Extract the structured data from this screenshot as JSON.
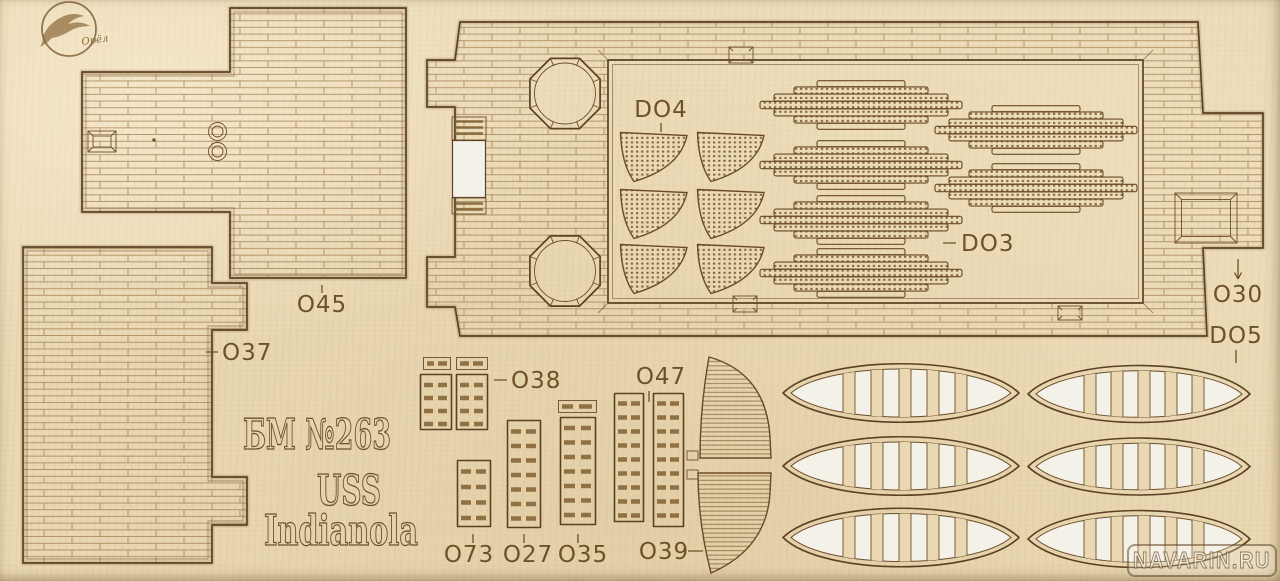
{
  "sheet": {
    "description": "Laser-cut plywood model parts sheet",
    "logo": {
      "brand": "Орёл"
    },
    "watermark": "NAVARIN.RU",
    "titles": {
      "kit": "БМ №263",
      "prefix": "USS",
      "name": "Indianola"
    },
    "labels": {
      "o45": "O45",
      "o37": "O37",
      "do4": "DO4",
      "do3": "DO3",
      "o30": "O30",
      "do5": "DO5",
      "o38": "O38",
      "o47": "O47",
      "o73": "O73",
      "o27": "O27",
      "o35": "O35",
      "o39": "O39"
    },
    "colors": {
      "wood": "#ecdcb8",
      "engrave": "#6e5128",
      "cut_edge": "#5a4122",
      "cutout": "#f4f1e8"
    }
  }
}
